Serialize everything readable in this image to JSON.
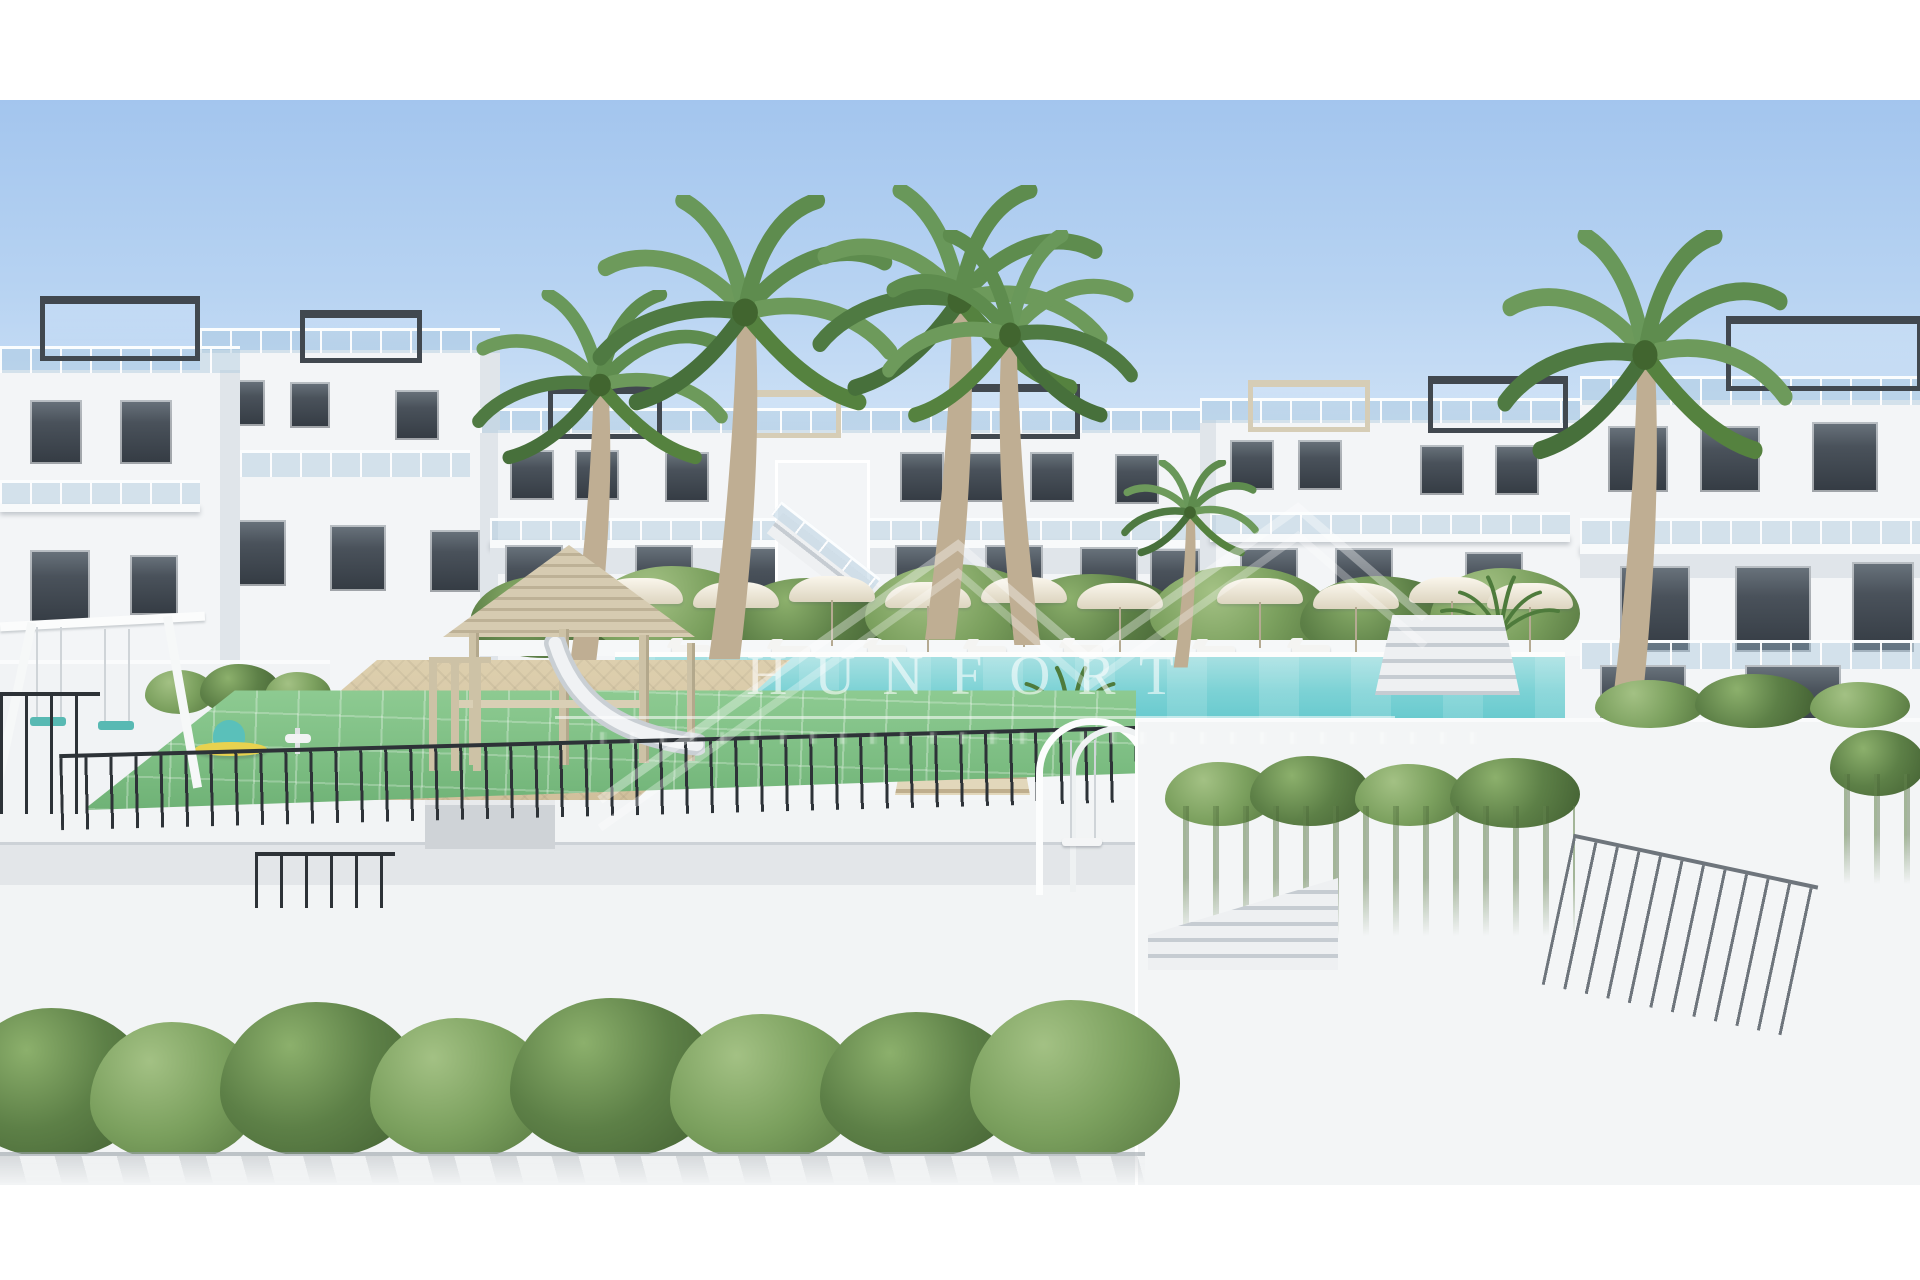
{
  "page": {
    "background": "#ffffff",
    "type": "architectural-rendering-photo"
  },
  "watermark": {
    "text": "HUNFORT",
    "color": "#ffffff",
    "opacity": 0.58,
    "has_logo_zigzag": true,
    "has_rule_line": true
  },
  "scene": {
    "description": "3D render of a white two/three-storey apartment complex with rooftop pergolas and glass balustrades, tall palm trees, a long turquoise communal pool lined with white parasols and sun loungers, a children's playground with green rubber tile flooring, a wooden play house with white slide, white arched swing frames, black metal fencing, tiered white terraces with Mediterranean planting and a long hedge in the foreground, under a clear blue sky.",
    "elements": [
      "sky",
      "apartment-buildings",
      "rooftop-pergolas",
      "glass-balustrades",
      "palm-trees",
      "pool",
      "parasols",
      "sun-loungers",
      "lawn",
      "playground",
      "play-house",
      "slide",
      "swing-frames",
      "spring-toys",
      "metal-fence",
      "terrace-walls",
      "planters",
      "stairs",
      "hedge"
    ]
  },
  "palette": {
    "sky_top": "#a3c5ee",
    "sky_horizon": "#e6eff9",
    "building_white": "#f3f5f7",
    "building_shadow": "#e0e5ea",
    "window_glass": "#4a525b",
    "pergola_frame": "#41484f",
    "pergola_light": "#d6cdb6",
    "pool_water_light": "#a6e0e2",
    "pool_water_deep": "#5fc6cb",
    "lawn": "#9cb173",
    "playground_floor": "#8ecb92",
    "foliage_dark": "#415e31",
    "foliage_light": "#7ba05e",
    "paving": "#d9c9a7",
    "wood": "#cdc2a6",
    "fence_dark": "#2d3237",
    "fence_gray": "#6e757c"
  }
}
